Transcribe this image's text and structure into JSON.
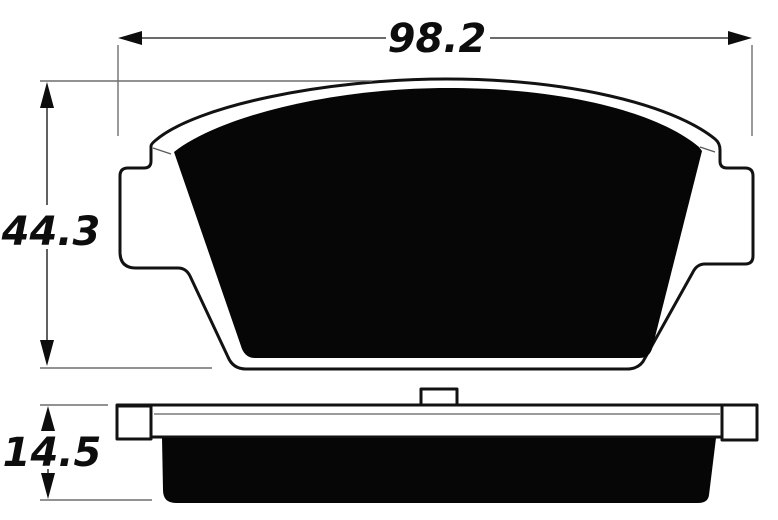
{
  "drawing": {
    "type": "brake-pad-dimensional-drawing",
    "views": {
      "front": "pad friction-surface view",
      "side": "pad edge view with backing plate"
    }
  },
  "dimensions": {
    "width": {
      "value": "98.2"
    },
    "height": {
      "value": "44.3"
    },
    "thickness": {
      "value": "14.5"
    }
  },
  "colors": {
    "bg": "#ffffff",
    "ink": "#0d0d0d",
    "outline": "#121212",
    "thin": "#6e6e6e",
    "black": "#060606"
  }
}
